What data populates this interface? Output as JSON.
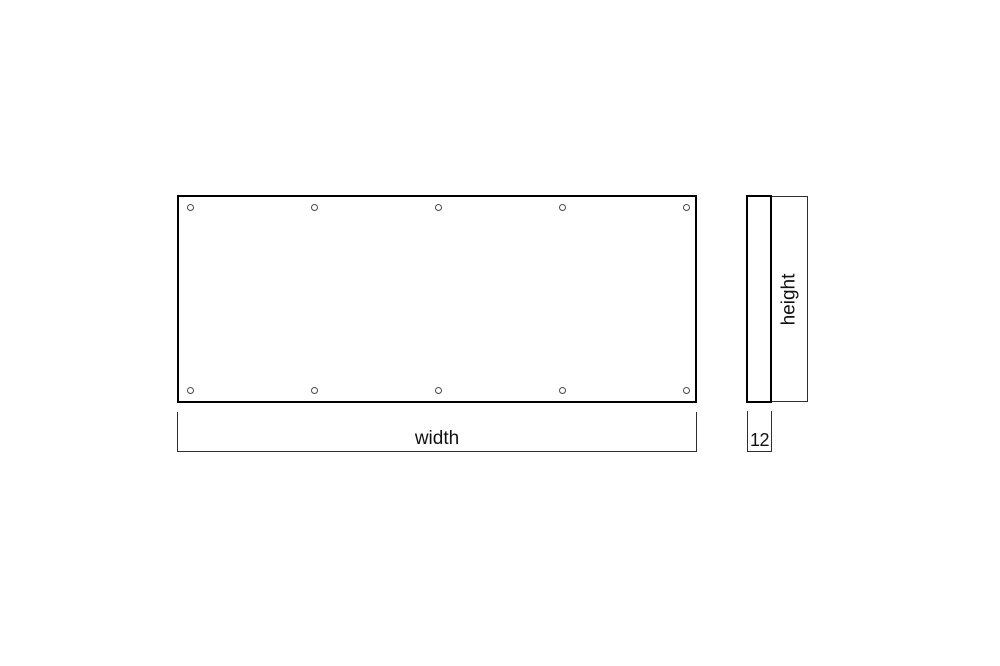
{
  "diagram": {
    "title": "panel-dimension-drawing",
    "front_view": {
      "top_hole_count": 5,
      "bottom_hole_count": 5
    },
    "labels": {
      "width": "width",
      "height": "height",
      "thickness": "12"
    },
    "colors": {
      "panel_outline": "#000000",
      "dimension_line": "#2f2f2f",
      "background": "#ffffff",
      "text": "#111111"
    }
  }
}
